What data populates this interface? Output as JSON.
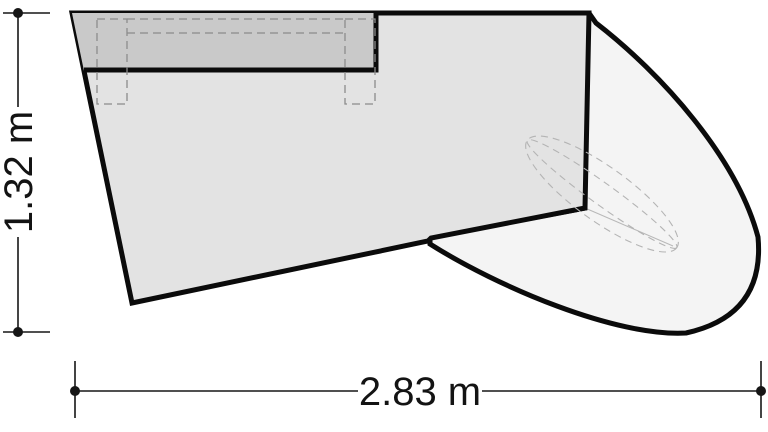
{
  "drawing": {
    "kind": "plan-view-technical-drawing",
    "dimensions": {
      "height_label": "1.32 m",
      "width_label": "2.83 m"
    },
    "colors": {
      "background": "#ffffff",
      "outline": "#0b0b0b",
      "body_fill": "#e3e3e3",
      "panel_fill": "#c9c9c9",
      "wing_fill": "#f4f4f4",
      "hidden_edge_dash": "#8c8c8c",
      "ellipse_dash": "#b4b4b4",
      "thin_line": "#b8b8b8",
      "dimension": "#161616"
    }
  }
}
